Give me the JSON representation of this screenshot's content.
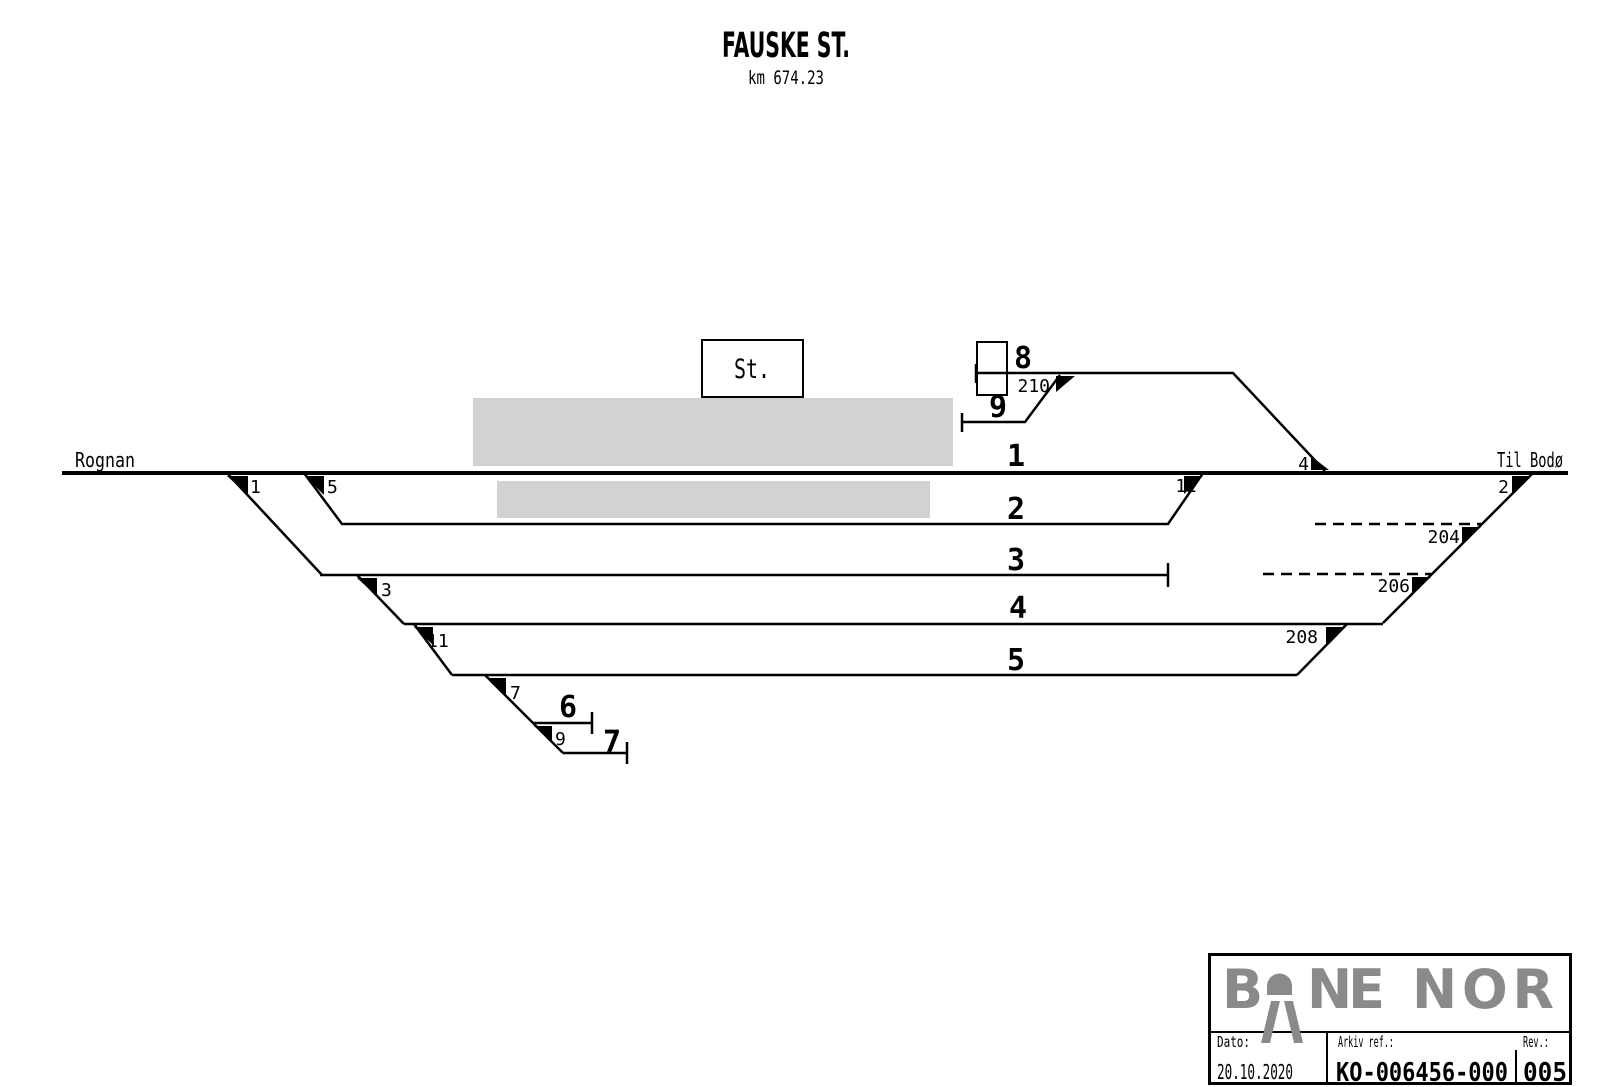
{
  "title": {
    "station": "FAUSKE ST.",
    "km": "km 674.23"
  },
  "directions": {
    "left": "Rognan",
    "right": "Til Bodø"
  },
  "station_building": {
    "label": "St."
  },
  "tracks": {
    "t1": "1",
    "t2": "2",
    "t3": "3",
    "t4": "4",
    "t5": "5",
    "t6": "6",
    "t7": "7",
    "t8": "8",
    "t9": "9"
  },
  "switches": {
    "s1": "1",
    "s2": "2",
    "s3": "3",
    "s4": "4",
    "s5": "5",
    "s7": "7",
    "s9": "9",
    "s11": "11",
    "s12": "12",
    "s204": "204",
    "s206": "206",
    "s208": "208",
    "s210": "210"
  },
  "brand": {
    "part1": "B",
    "part2": "NE",
    "part3": "NOR"
  },
  "title_block": {
    "date_label": "Dato:",
    "date_value": "20.10.2020",
    "archive_label": "Arkiv ref.:",
    "archive_value": "KO-006456-000",
    "rev_label": "Rev.:",
    "rev_value": "005"
  },
  "colors": {
    "line": "#000000",
    "platform": "#d2d2d2",
    "logo": "#8a8a8a",
    "background": "#ffffff"
  }
}
